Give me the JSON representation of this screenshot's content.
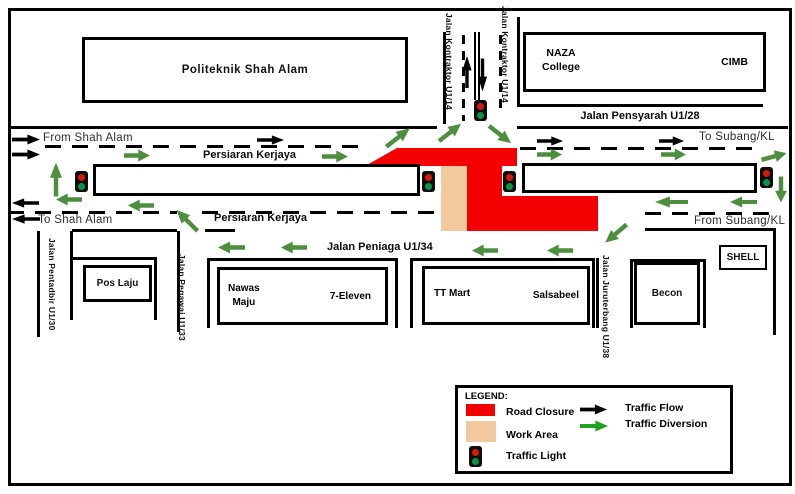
{
  "colors": {
    "road_closure": "#F50000",
    "work_area": "#F2C89E",
    "traffic_flow": "#000000",
    "traffic_diversion": "#4E8F3F",
    "legend_diversion": "#22A022",
    "signal_red": "#D6190A",
    "signal_green": "#0B9444"
  },
  "buildings": {
    "politeknik": "Politeknik  Shah Alam",
    "naza_line1": "NAZA",
    "naza_line2": "College",
    "cimb": "CIMB",
    "pos_laju": "Pos Laju",
    "nawas_line1": "Nawas",
    "nawas_line2": "Maju",
    "seven_eleven": "7-Eleven",
    "tt_mart": "TT Mart",
    "salsabeel": "Salsabeel",
    "becon": "Becon",
    "shell": "SHELL"
  },
  "roads": {
    "persiaran_kerjaya": "Persiaran Kerjaya",
    "jalan_pensyarah": "Jalan Pensyarah U1/28",
    "jalan_peniaga": "Jalan Peniaga U1/34",
    "jalan_kontraktor": "Jalan Kontraktor U1/14",
    "jalan_pentadbir": "Jalan Pentadbir U1/30",
    "jalan_pegawai": "Jalan Pegawai U1/33",
    "jalan_juruterbang": "Jalan Juruterbang U1/38"
  },
  "directions": {
    "from_shah_alam": "From Shah Alam",
    "to_shah_alam": "To Shah Alam",
    "to_subang": "To Subang/KL",
    "from_subang": "From Subang/KL"
  },
  "legend": {
    "title": "LEGEND:",
    "road_closure": "Road Closure",
    "work_area": "Work Area",
    "traffic_light": "Traffic Light",
    "traffic_flow": "Traffic Flow",
    "traffic_diversion": "Traffic Diversion"
  }
}
